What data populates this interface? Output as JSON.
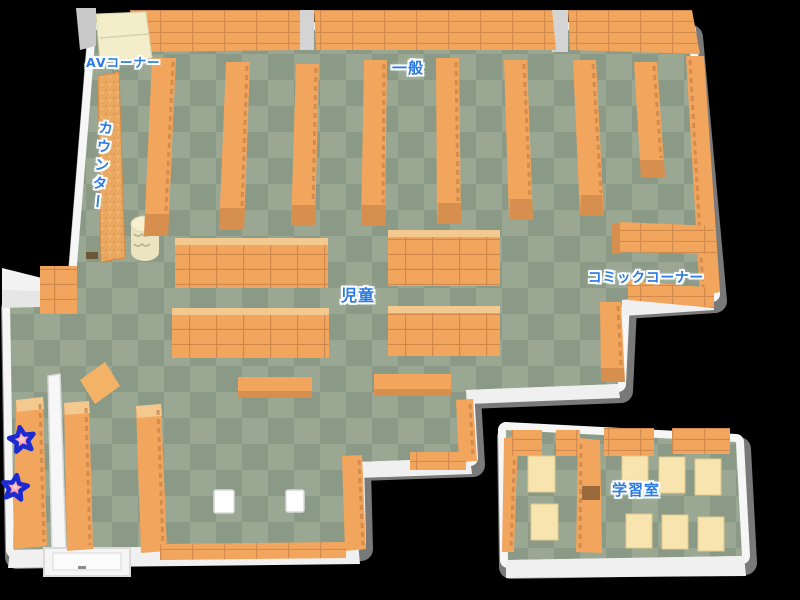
{
  "map": {
    "type": "library-floor-map",
    "areas": {
      "av_corner": {
        "label": "AVコーナー"
      },
      "counter": {
        "label": "カウンター"
      },
      "general": {
        "label": "一般"
      },
      "children": {
        "label": "児童"
      },
      "comic_corner": {
        "label": "コミックコーナー"
      },
      "study_room": {
        "label": "学習室"
      }
    },
    "markers": [
      {
        "name": "star-marker-1",
        "shape": "star"
      },
      {
        "name": "star-marker-2",
        "shape": "star"
      }
    ],
    "colors": {
      "background": "#000000",
      "floor_light": "#99a793",
      "floor_dark": "#8b9a86",
      "wall": "#f6f6f6",
      "wall_shade": "#c9c9c9",
      "shelf": "#f2a55c",
      "shelf_line": "#c8834a",
      "shelf_cap": "#d78f4f",
      "shelf_top": "#f3c98f",
      "counter_base": "#eaa75f",
      "av_shelf": "#f3edca",
      "table": "#f7e4ae",
      "stool": "#ffffff",
      "cylinder": "#ece4bf",
      "label_text": "#2b7be4",
      "star_outline": "#1b2bd0",
      "star_red": "#e92d49",
      "star_pink": "#ff8f9b"
    }
  }
}
